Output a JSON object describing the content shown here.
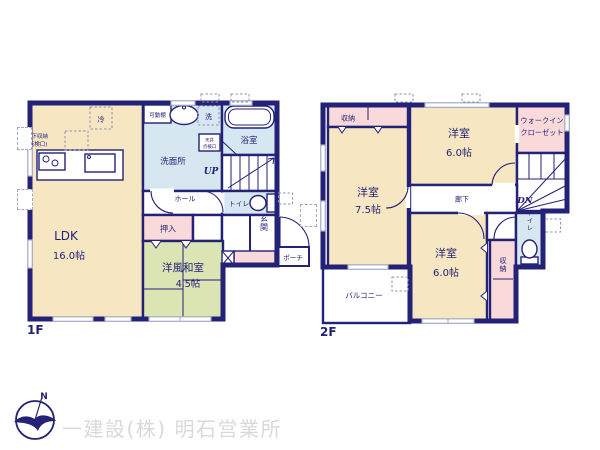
{
  "colors": {
    "wall": "#232277",
    "room_beige": "#f6e7c2",
    "room_green": "#dbe4b3",
    "room_blue": "#d7e7f1",
    "room_pink": "#f9d9d9",
    "window_gray": "#a3a9c6",
    "footer_gray": "#d9d9d9"
  },
  "floor1": {
    "label": "1F",
    "ldk": {
      "name": "LDK",
      "size": "16.0帖"
    },
    "washitsu": {
      "name": "洋風和室",
      "size": "4.5帖"
    },
    "fridge": "冷",
    "underfloor1": "床下収納",
    "underfloor2": "(点検口)",
    "shelf": "可動棚",
    "laundry": "洗",
    "washroom": "洗面所",
    "hatch1": "天井",
    "hatch2": "点検口",
    "bath": "浴室",
    "up": "UP",
    "toilet": "トイレ",
    "hall": "ホール",
    "closet": "押入",
    "entrance": "玄関",
    "porch": "ポーチ"
  },
  "floor2": {
    "label": "2F",
    "storage": "収納",
    "room75": {
      "name": "洋室",
      "size": "7.5帖"
    },
    "room60a": {
      "name": "洋室",
      "size": "6.0帖"
    },
    "room60b": {
      "name": "洋室",
      "size": "6.0帖"
    },
    "wic1": "ウォークイン",
    "wic2": "クローゼット",
    "corridor": "廊下",
    "dn": "DN",
    "toilet": "トイレ",
    "storage2": "収納",
    "balcony": "バルコニー"
  },
  "footer": {
    "company": "一建設(株) 明石営業所",
    "compass_n": "N"
  }
}
